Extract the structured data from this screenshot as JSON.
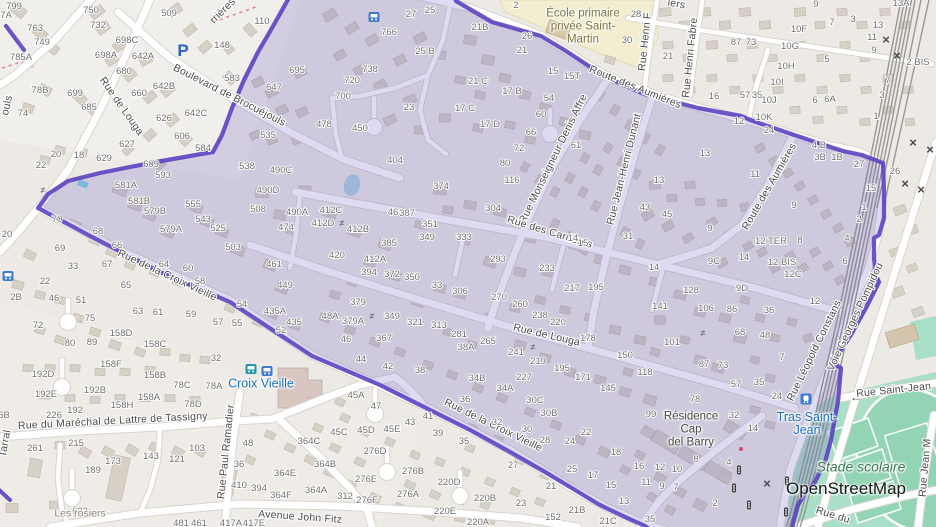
{
  "attribution": {
    "label": "OpenStreetMap"
  },
  "colors": {
    "boundary": "#5a3fc0",
    "highlight_fill": "rgba(98,88,190,0.22)",
    "school_area": "#f2eecf",
    "pitch": "#a9dfc6",
    "pitch_dark": "#93d4b4",
    "water": "#abd4e0",
    "road": "#ffffff",
    "road_casing": "#d8d5d0",
    "building": "#d7d0c6",
    "building_line": "#c3bbb0",
    "rail": "#9b9893",
    "street_label": "#4b4b4b",
    "house_number": "#6f6f6f",
    "path_red": "#e08585",
    "transit_blue": "#3e7ad1",
    "transit_teal": "#2196ad"
  },
  "pois": {
    "school_line1": "École primaire",
    "school_line2": "privée Saint-",
    "school_line3": "Martin",
    "croix_vieille": "Croix Vieille",
    "tras_line1": "Tras Saint-",
    "tras_line2": "Jean",
    "residence_line1": "Résidence",
    "residence_line2": "Cap",
    "residence_line3": "del Barry",
    "stade": "Stade scolaire",
    "les_rosiers": "Les rosiers"
  },
  "street_labels": [
    [
      "Boulevard de Brocuéjouls",
      228,
      98,
      27
    ],
    [
      "Rue de Louga",
      119,
      108,
      55
    ],
    [
      "rrières",
      225,
      13,
      -45
    ],
    [
      "iers",
      676,
      7,
      10
    ],
    [
      "Rue de Louga",
      546,
      338,
      13
    ],
    [
      "Rue Monseigneur Denis Affre",
      556,
      160,
      -64
    ],
    [
      "Rue Jean-Henri Dunant",
      627,
      170,
      -76
    ],
    [
      "Rue Henri F",
      648,
      42,
      -84
    ],
    [
      "Rue Henri Fabre",
      693,
      58,
      -84
    ],
    [
      "Route des Aumières",
      634,
      90,
      22
    ],
    [
      "Route des Aumières",
      772,
      188,
      -60
    ],
    [
      "Rue des Carrières",
      549,
      235,
      17
    ],
    [
      "Rue de la Croix Vieille",
      166,
      278,
      25
    ],
    [
      "Rue de la Croix Vieille",
      492,
      428,
      26
    ],
    [
      "Rue du Maréchal de Lattre de Tassigny",
      113,
      424,
      -3
    ],
    [
      "Rue Paul Ramadier",
      229,
      452,
      -84
    ],
    [
      "Avenue John Fitz",
      300,
      520,
      4
    ],
    [
      "Rue Léopold Constans",
      817,
      352,
      -64
    ],
    [
      "Voie Georges Pompidou",
      858,
      318,
      -65
    ],
    [
      "Rue Saint-Jean",
      894,
      393,
      -6
    ],
    [
      "Rue Jean M",
      928,
      468,
      -85
    ],
    [
      "Rue du",
      832,
      518,
      17
    ],
    [
      "ouls",
      10,
      106,
      -78
    ],
    [
      "Tarral",
      8,
      444,
      -80
    ]
  ],
  "house_numbers": [
    [
      "799",
      14,
      6
    ],
    [
      "7A",
      6,
      15
    ],
    [
      "763",
      35,
      28
    ],
    [
      "749",
      42,
      42
    ],
    [
      "785A",
      21,
      57
    ],
    [
      "78B",
      40,
      90
    ],
    [
      "74",
      23,
      113
    ],
    [
      "699",
      75,
      93
    ],
    [
      "685",
      89,
      107
    ],
    [
      "509",
      169,
      13
    ],
    [
      "750",
      91,
      10
    ],
    [
      "732",
      98,
      25
    ],
    [
      "698C",
      127,
      40
    ],
    [
      "698A",
      106,
      55
    ],
    [
      "642A",
      143,
      56
    ],
    [
      "680",
      124,
      71
    ],
    [
      "660",
      139,
      93
    ],
    [
      "642B",
      164,
      86
    ],
    [
      "642C",
      196,
      113
    ],
    [
      "626",
      164,
      118
    ],
    [
      "606",
      182,
      136
    ],
    [
      "627",
      127,
      144
    ],
    [
      "629",
      104,
      158
    ],
    [
      "609",
      151,
      164
    ],
    [
      "593",
      163,
      175
    ],
    [
      "584",
      203,
      148
    ],
    [
      "538",
      247,
      166
    ],
    [
      "490C",
      281,
      170
    ],
    [
      "535",
      268,
      135
    ],
    [
      "647",
      274,
      87
    ],
    [
      "695",
      297,
      70
    ],
    [
      "583",
      232,
      78
    ],
    [
      "148",
      222,
      45
    ],
    [
      "110",
      262,
      21
    ],
    [
      "22",
      41,
      165
    ],
    [
      "20",
      56,
      154
    ],
    [
      "18",
      79,
      155
    ],
    [
      "27",
      411,
      14
    ],
    [
      "25",
      430,
      10
    ],
    [
      "766",
      389,
      32
    ],
    [
      "25 B",
      425,
      51
    ],
    [
      "738",
      370,
      69
    ],
    [
      "720",
      352,
      80
    ],
    [
      "700",
      343,
      96
    ],
    [
      "478",
      324,
      124
    ],
    [
      "450",
      360,
      128
    ],
    [
      "23",
      409,
      107
    ],
    [
      "404",
      395,
      160
    ],
    [
      "2",
      516,
      5
    ],
    [
      "26",
      527,
      36
    ],
    [
      "21",
      522,
      50
    ],
    [
      "21B",
      480,
      27
    ],
    [
      "21 C",
      478,
      81
    ],
    [
      "17 B",
      512,
      91
    ],
    [
      "17 C",
      465,
      108
    ],
    [
      "17 D",
      490,
      124
    ],
    [
      "15",
      553,
      71
    ],
    [
      "15T",
      572,
      76
    ],
    [
      "54",
      549,
      98
    ],
    [
      "60",
      541,
      114
    ],
    [
      "66",
      531,
      132
    ],
    [
      "72",
      519,
      148
    ],
    [
      "80",
      505,
      163
    ],
    [
      "61",
      576,
      145
    ],
    [
      "116",
      512,
      180
    ],
    [
      "28",
      636,
      14
    ],
    [
      "30",
      627,
      40
    ],
    [
      "21",
      668,
      56
    ],
    [
      "16",
      714,
      96
    ],
    [
      "9",
      816,
      4
    ],
    [
      "7",
      832,
      22
    ],
    [
      "3",
      853,
      19
    ],
    [
      "13",
      878,
      25
    ],
    [
      "11",
      872,
      37
    ],
    [
      "9",
      874,
      50
    ],
    [
      "5",
      827,
      59
    ],
    [
      "13A",
      901,
      3
    ],
    [
      "2 BIS",
      918,
      62
    ],
    [
      "7",
      888,
      80
    ],
    [
      "3",
      882,
      95
    ],
    [
      "1",
      876,
      116
    ],
    [
      "10F",
      799,
      29
    ],
    [
      "10G",
      790,
      46
    ],
    [
      "10H",
      786,
      66
    ],
    [
      "10I",
      777,
      82
    ],
    [
      "10J",
      769,
      100
    ],
    [
      "10K",
      764,
      117
    ],
    [
      "6",
      815,
      100
    ],
    [
      "6A",
      830,
      99
    ],
    [
      "12",
      739,
      121
    ],
    [
      "13",
      705,
      153
    ],
    [
      "4 B",
      819,
      145
    ],
    [
      "3B",
      820,
      157
    ],
    [
      "1B",
      837,
      157
    ],
    [
      "27",
      859,
      164
    ],
    [
      "26",
      895,
      171
    ],
    [
      "11",
      755,
      174
    ],
    [
      "581A",
      126,
      185
    ],
    [
      "581B",
      139,
      201
    ],
    [
      "579B",
      155,
      211
    ],
    [
      "579A",
      171,
      229
    ],
    [
      "555",
      193,
      204
    ],
    [
      "543",
      203,
      219
    ],
    [
      "525",
      218,
      228
    ],
    [
      "503",
      233,
      247
    ],
    [
      "490D",
      268,
      190
    ],
    [
      "508",
      258,
      209
    ],
    [
      "490A",
      297,
      212
    ],
    [
      "474",
      286,
      227
    ],
    [
      "461",
      274,
      264
    ],
    [
      "449",
      285,
      285
    ],
    [
      "435A",
      275,
      311
    ],
    [
      "435",
      294,
      322
    ],
    [
      "70",
      57,
      219
    ],
    [
      "68",
      98,
      231
    ],
    [
      "66",
      117,
      245
    ],
    [
      "67",
      107,
      264
    ],
    [
      "64",
      164,
      264
    ],
    [
      "60",
      188,
      268
    ],
    [
      "58",
      200,
      281
    ],
    [
      "54",
      242,
      304
    ],
    [
      "52",
      281,
      330
    ],
    [
      "69",
      60,
      248
    ],
    [
      "33",
      73,
      266
    ],
    [
      "22",
      45,
      281
    ],
    [
      "46",
      54,
      298
    ],
    [
      "51",
      81,
      300
    ],
    [
      "2B",
      16,
      297
    ],
    [
      "72",
      38,
      325
    ],
    [
      "75",
      90,
      318
    ],
    [
      "65",
      126,
      285
    ],
    [
      "63",
      138,
      311
    ],
    [
      "61",
      158,
      312
    ],
    [
      "59",
      191,
      314
    ],
    [
      "57",
      218,
      322
    ],
    [
      "55",
      237,
      323
    ],
    [
      "158D",
      121,
      333
    ],
    [
      "158C",
      155,
      344
    ],
    [
      "80",
      70,
      343
    ],
    [
      "89",
      92,
      342
    ],
    [
      "20",
      7,
      234
    ],
    [
      "374",
      441,
      186
    ],
    [
      "304",
      493,
      208
    ],
    [
      "412C",
      331,
      210
    ],
    [
      "412D",
      323,
      223
    ],
    [
      "412B",
      358,
      229
    ],
    [
      "46",
      393,
      212
    ],
    [
      "387",
      407,
      213
    ],
    [
      "351",
      430,
      224
    ],
    [
      "349",
      427,
      237
    ],
    [
      "333",
      464,
      237
    ],
    [
      "385",
      389,
      243
    ],
    [
      "420",
      337,
      255
    ],
    [
      "412A",
      375,
      259
    ],
    [
      "394",
      369,
      272
    ],
    [
      "372",
      392,
      274
    ],
    [
      "350",
      412,
      277
    ],
    [
      "33",
      437,
      285
    ],
    [
      "306",
      460,
      291
    ],
    [
      "270",
      499,
      297
    ],
    [
      "260",
      520,
      304
    ],
    [
      "293",
      498,
      259
    ],
    [
      "233",
      547,
      268
    ],
    [
      "14",
      573,
      238
    ],
    [
      "15",
      583,
      243
    ],
    [
      "217",
      572,
      288
    ],
    [
      "195",
      596,
      287
    ],
    [
      "238",
      540,
      315
    ],
    [
      "220",
      558,
      322
    ],
    [
      "178",
      588,
      338
    ],
    [
      "150",
      625,
      355
    ],
    [
      "141",
      660,
      306
    ],
    [
      "128",
      691,
      290
    ],
    [
      "106",
      706,
      308
    ],
    [
      "86",
      732,
      309
    ],
    [
      "101",
      672,
      342
    ],
    [
      "68",
      740,
      332
    ],
    [
      "87",
      704,
      364
    ],
    [
      "73",
      723,
      365
    ],
    [
      "57",
      736,
      384
    ],
    [
      "118",
      645,
      372
    ],
    [
      "171",
      583,
      377
    ],
    [
      "195",
      562,
      368
    ],
    [
      "145",
      608,
      388
    ],
    [
      "241",
      516,
      352
    ],
    [
      "219",
      538,
      361
    ],
    [
      "227",
      524,
      377
    ],
    [
      "379",
      358,
      302
    ],
    [
      "48A",
      330,
      316
    ],
    [
      "379A",
      353,
      321
    ],
    [
      "349",
      392,
      316
    ],
    [
      "321",
      415,
      322
    ],
    [
      "313",
      439,
      325
    ],
    [
      "281",
      459,
      334
    ],
    [
      "265",
      488,
      341
    ],
    [
      "38A",
      466,
      347
    ],
    [
      "46",
      346,
      339
    ],
    [
      "367",
      384,
      338
    ],
    [
      "13",
      659,
      180
    ],
    [
      "43",
      645,
      207
    ],
    [
      "45",
      667,
      214
    ],
    [
      "9",
      710,
      228
    ],
    [
      "31",
      628,
      236
    ],
    [
      "14",
      654,
      267
    ],
    [
      "36",
      769,
      310
    ],
    [
      "48",
      765,
      335
    ],
    [
      "9C",
      714,
      261
    ],
    [
      "14",
      744,
      257
    ],
    [
      "9D",
      742,
      288
    ],
    [
      "12 TER",
      771,
      241
    ],
    [
      "12 BIS",
      782,
      262
    ],
    [
      "12C",
      793,
      274
    ],
    [
      "8",
      800,
      240
    ],
    [
      "9",
      794,
      205
    ],
    [
      "15",
      871,
      188
    ],
    [
      "1",
      864,
      207
    ],
    [
      "2",
      859,
      219
    ],
    [
      "4",
      847,
      238
    ],
    [
      "6",
      845,
      261
    ],
    [
      "12",
      815,
      301
    ],
    [
      "192D",
      43,
      374
    ],
    [
      "192E",
      46,
      394
    ],
    [
      "226",
      54,
      415
    ],
    [
      "192",
      75,
      410
    ],
    [
      "192B",
      95,
      390
    ],
    [
      "158F",
      111,
      364
    ],
    [
      "158B",
      155,
      375
    ],
    [
      "158A",
      149,
      397
    ],
    [
      "158H",
      122,
      405
    ],
    [
      "78C",
      182,
      385
    ],
    [
      "78A",
      214,
      386
    ],
    [
      "78D",
      193,
      404
    ],
    [
      "32",
      216,
      358
    ],
    [
      "261",
      35,
      448
    ],
    [
      "215",
      76,
      443
    ],
    [
      "189",
      93,
      470
    ],
    [
      "173",
      113,
      461
    ],
    [
      "143",
      151,
      456
    ],
    [
      "121",
      177,
      459
    ],
    [
      "103",
      197,
      448
    ],
    [
      "48",
      248,
      443
    ],
    [
      "36",
      239,
      464
    ],
    [
      "410",
      239,
      485
    ],
    [
      "394",
      259,
      488
    ],
    [
      "364E",
      285,
      473
    ],
    [
      "364F",
      281,
      495
    ],
    [
      "622",
      80,
      511
    ],
    [
      "6B",
      4,
      415
    ],
    [
      "364C",
      309,
      441
    ],
    [
      "364B",
      325,
      464
    ],
    [
      "364A",
      316,
      490
    ],
    [
      "312",
      345,
      496
    ],
    [
      "44",
      361,
      359
    ],
    [
      "42",
      388,
      366
    ],
    [
      "38",
      420,
      370
    ],
    [
      "34B",
      477,
      378
    ],
    [
      "34A",
      505,
      388
    ],
    [
      "36",
      465,
      399
    ],
    [
      "32",
      497,
      422
    ],
    [
      "30C",
      535,
      400
    ],
    [
      "30B",
      549,
      413
    ],
    [
      "30",
      527,
      429
    ],
    [
      "28",
      545,
      440
    ],
    [
      "24",
      570,
      441
    ],
    [
      "22",
      586,
      432
    ],
    [
      "18",
      616,
      452
    ],
    [
      "17",
      593,
      475
    ],
    [
      "15",
      611,
      485
    ],
    [
      "13",
      624,
      501
    ],
    [
      "27",
      513,
      465
    ],
    [
      "25",
      572,
      469
    ],
    [
      "21",
      551,
      486
    ],
    [
      "23",
      521,
      503
    ],
    [
      "21B",
      577,
      510
    ],
    [
      "21C",
      608,
      521
    ],
    [
      "152",
      553,
      517
    ],
    [
      "45A",
      356,
      395
    ],
    [
      "47",
      376,
      406
    ],
    [
      "43",
      410,
      422
    ],
    [
      "41",
      428,
      416
    ],
    [
      "39",
      438,
      433
    ],
    [
      "35",
      464,
      441
    ],
    [
      "45C",
      339,
      432
    ],
    [
      "45D",
      366,
      430
    ],
    [
      "45E",
      392,
      429
    ],
    [
      "276D",
      375,
      451
    ],
    [
      "276E",
      366,
      479
    ],
    [
      "276B",
      413,
      471
    ],
    [
      "220D",
      449,
      482
    ],
    [
      "276F",
      367,
      500
    ],
    [
      "276A",
      408,
      494
    ],
    [
      "220E",
      445,
      511
    ],
    [
      "220B",
      485,
      498
    ],
    [
      "220A",
      478,
      522
    ],
    [
      "99",
      651,
      414
    ],
    [
      "78",
      695,
      399
    ],
    [
      "32",
      734,
      415
    ],
    [
      "14",
      753,
      428
    ],
    [
      "8",
      696,
      459
    ],
    [
      "4",
      729,
      462
    ],
    [
      "16",
      639,
      466
    ],
    [
      "12",
      660,
      467
    ],
    [
      "10",
      677,
      469
    ],
    [
      "11",
      646,
      482
    ],
    [
      "9",
      662,
      486
    ],
    [
      "7",
      676,
      487
    ],
    [
      "2",
      715,
      503
    ],
    [
      "35",
      650,
      519
    ],
    [
      "7",
      782,
      357
    ],
    [
      "35",
      759,
      382
    ],
    [
      "24",
      777,
      396
    ],
    [
      "87",
      736,
      42
    ],
    [
      "73",
      751,
      42
    ],
    [
      "57",
      745,
      95
    ],
    [
      "35",
      757,
      95
    ],
    [
      "24",
      769,
      130
    ],
    [
      "481",
      181,
      523
    ],
    [
      "461",
      199,
      523
    ],
    [
      "417A",
      231,
      523
    ],
    [
      "417E",
      254,
      523
    ]
  ],
  "icons": [
    [
      "parking-icon",
      183,
      50
    ],
    [
      "bus-stop-icon",
      374,
      17
    ],
    [
      "bus-stop-icon",
      8,
      276
    ],
    [
      "bus-stop-teal-icon",
      251,
      369
    ],
    [
      "bus-stop-icon",
      267,
      371
    ],
    [
      "rail-station-icon",
      806,
      399
    ],
    [
      "traffic-signal-icon",
      739,
      470
    ],
    [
      "traffic-signal-icon",
      734,
      488
    ],
    [
      "traffic-signal-icon",
      749,
      505
    ],
    [
      "traffic-signal-icon",
      787,
      481
    ],
    [
      "traffic-signal-icon",
      786,
      512
    ],
    [
      "level-crossing-icon",
      886,
      40
    ],
    [
      "level-crossing-icon",
      897,
      56
    ],
    [
      "level-crossing-icon",
      913,
      143
    ],
    [
      "level-crossing-icon",
      930,
      150
    ],
    [
      "level-crossing-icon",
      905,
      184
    ],
    [
      "level-crossing-icon",
      921,
      190
    ],
    [
      "level-crossing-icon",
      767,
      484
    ],
    [
      "gate-icon",
      342,
      223
    ],
    [
      "gate-icon",
      372,
      316
    ],
    [
      "gate-icon",
      533,
      347
    ],
    [
      "gate-icon",
      703,
      333
    ],
    [
      "gate-icon",
      43,
      190
    ],
    [
      "one-way-arrow-icon",
      856,
      397
    ]
  ]
}
